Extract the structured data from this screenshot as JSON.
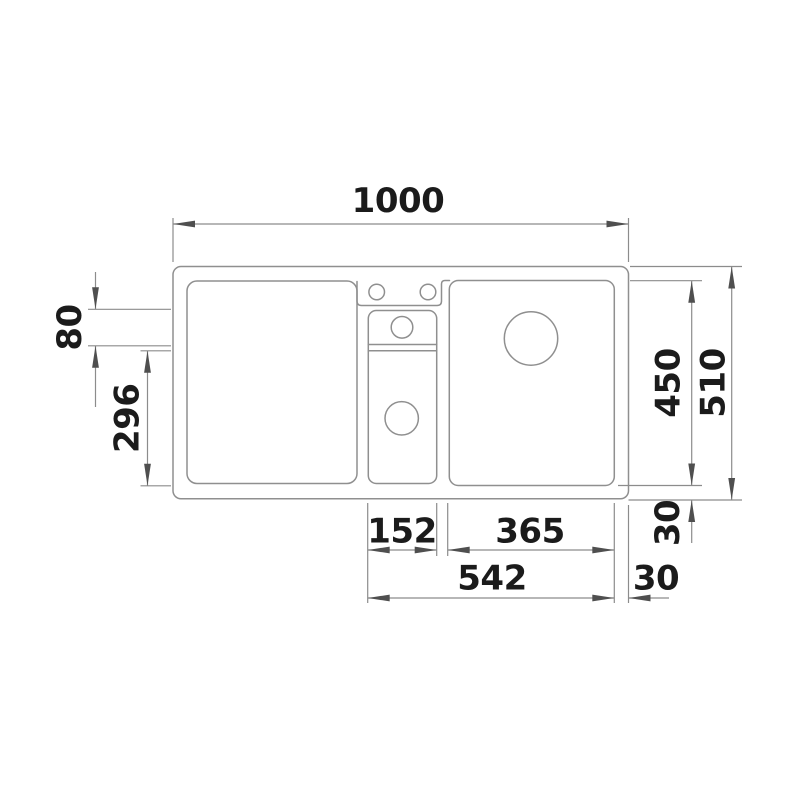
{
  "page": {
    "background_color": "#ffffff"
  },
  "drawing": {
    "description": "sink-top-view-technical-drawing",
    "line_color": "#8f8f8f",
    "arrow_color": "#4f4f4f",
    "text_color": "#1b1b1b",
    "dimensions": {
      "overall_width": "1000",
      "overall_depth": "510",
      "main_bowl_height": "450",
      "tray_height": "80",
      "half_bowl_height": "296",
      "half_bowl_width": "152",
      "main_bowl_width": "365",
      "bowls_total_width": "542",
      "bottom_rim": "30",
      "right_rim": "30"
    }
  }
}
